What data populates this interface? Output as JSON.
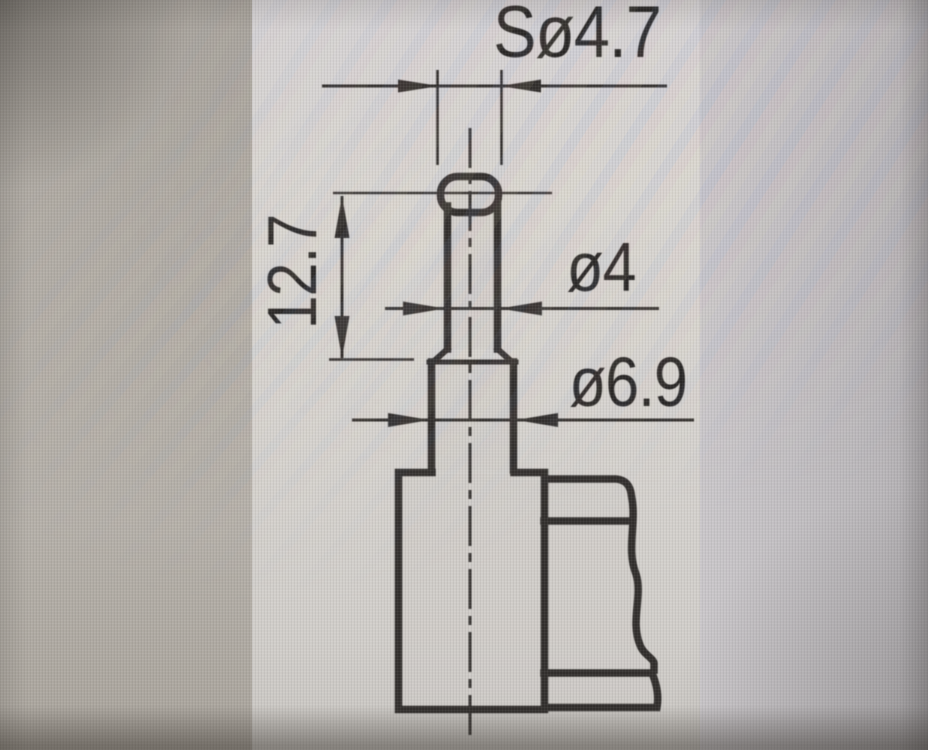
{
  "drawing": {
    "type": "technical-dimension-drawing",
    "subject": "measuring contact point on instrument body",
    "labels": {
      "sphere_dia": "Sø4.7",
      "tip_length": "12.7",
      "stem_dia": "ø4",
      "mount_dia": "ø6.9"
    },
    "colors": {
      "ink": "#33302e",
      "panel": "#d8d5d1",
      "screen_left": "#b1aca5",
      "screen_right": "#bdbabd"
    }
  }
}
